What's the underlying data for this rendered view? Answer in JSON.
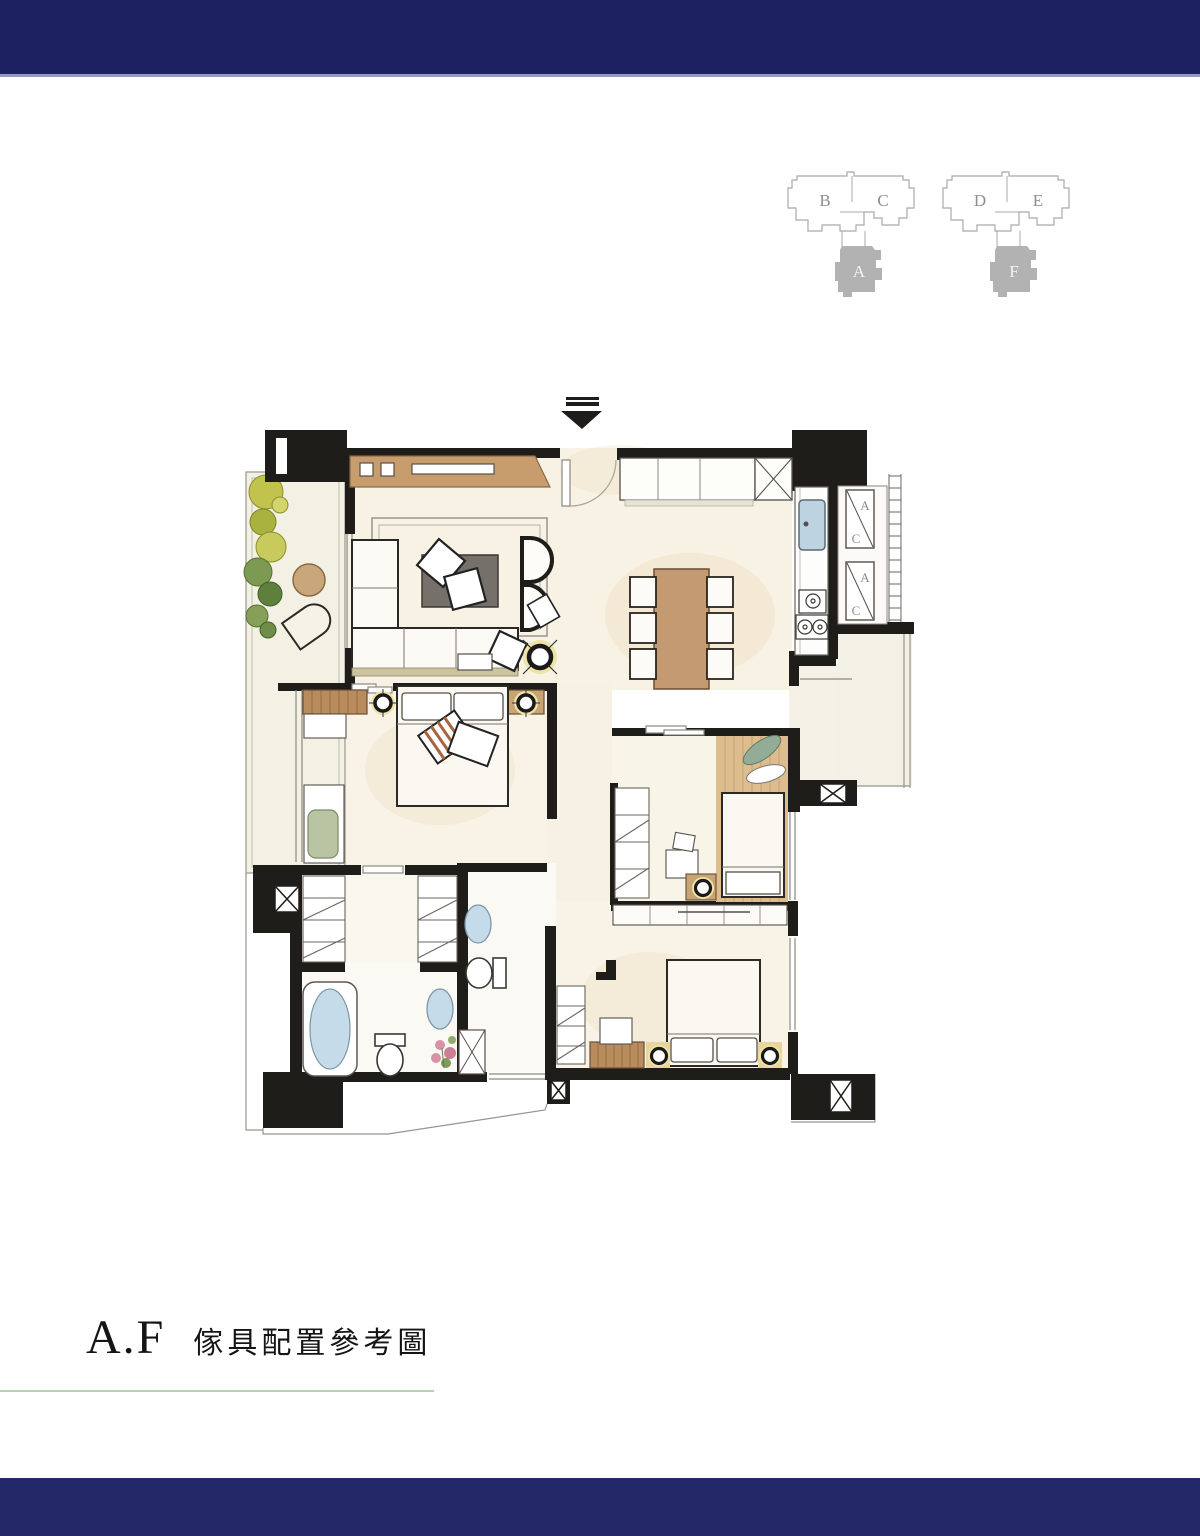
{
  "title": {
    "code": "A.F",
    "label": "傢具配置參考圖"
  },
  "keyplans": [
    {
      "units_top": [
        "B",
        "C"
      ],
      "unit_bottom": "A"
    },
    {
      "units_top": [
        "D",
        "E"
      ],
      "unit_bottom": "F"
    }
  ],
  "floorplan": {
    "ac_labels": {
      "top": "A",
      "bottom": "C"
    }
  },
  "colors": {
    "banner_navy": "#1d2161",
    "banner_navy_bottom": "#232968",
    "accent_green_line": "#b7d2b2",
    "wall_black": "#1f1d1a",
    "floor_cream": "#f7f2e3",
    "balcony_cream": "#f3f0e4",
    "wood_tan": "#c49a72",
    "keyplan_gray": "#b2b2b2",
    "water_blue": "#c6dbe9",
    "lamp_yellow": "#efe3a6",
    "plant_green": "#7d9a52",
    "chair_green": "#b9c4a2"
  }
}
